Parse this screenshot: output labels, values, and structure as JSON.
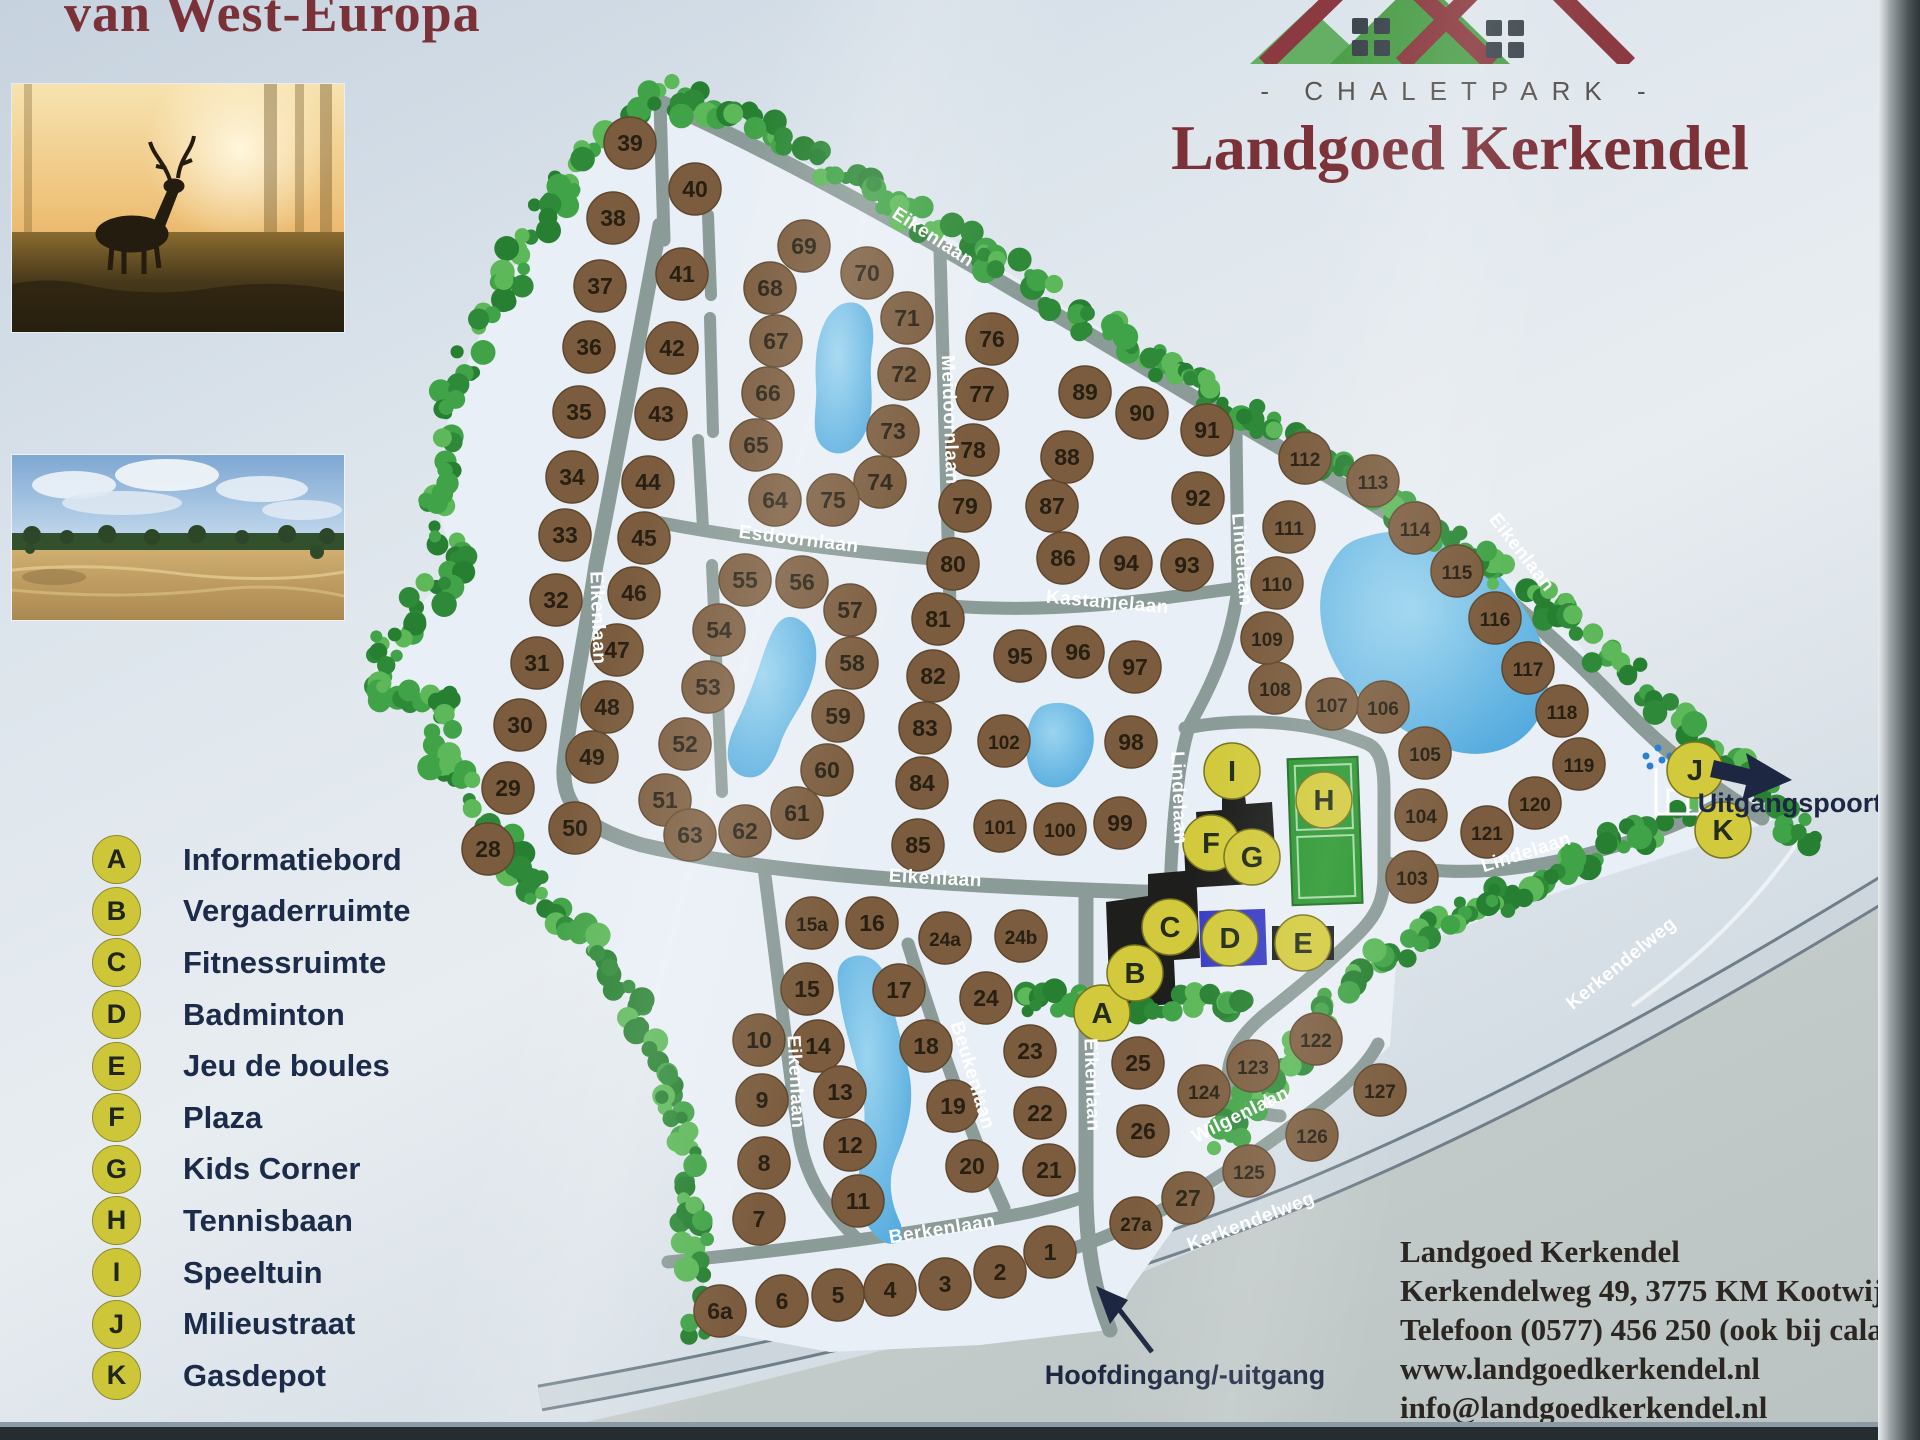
{
  "sign": {
    "top_left_title": "van West-Europa",
    "brand": {
      "park_type": "- CHALETPARK -",
      "name": "Landgoed Kerkendel"
    },
    "contact": {
      "name": "Landgoed Kerkendel",
      "address": "Kerkendelweg 49, 3775 KM Kootwijk",
      "phone": "Telefoon (0577) 456 250 (ook bij calamiteiten)",
      "website": "www.landgoedkerkendel.nl",
      "email": "info@landgoedkerkendel.nl"
    }
  },
  "legend": {
    "items": [
      {
        "key": "A",
        "label": "Informatiebord"
      },
      {
        "key": "B",
        "label": "Vergaderruimte"
      },
      {
        "key": "C",
        "label": "Fitnessruimte"
      },
      {
        "key": "D",
        "label": "Badminton"
      },
      {
        "key": "E",
        "label": "Jeu de boules"
      },
      {
        "key": "F",
        "label": "Plaza"
      },
      {
        "key": "G",
        "label": "Kids Corner"
      },
      {
        "key": "H",
        "label": "Tennisbaan"
      },
      {
        "key": "I",
        "label": "Speeltuin"
      },
      {
        "key": "J",
        "label": "Milieustraat"
      },
      {
        "key": "K",
        "label": "Gasdepot"
      }
    ]
  },
  "map": {
    "labels": {
      "entrance": {
        "text": "Hoofdingang/-uitgang",
        "x": 1185,
        "y": 1384
      },
      "exit": {
        "text": "Uitgangspoort",
        "x": 1790,
        "y": 812
      }
    },
    "icons": {
      "milieustraat": "container-station-icon",
      "entrance_arrow": "arrow-up-left-icon",
      "exit_arrow": "arrow-right-icon"
    },
    "colors": {
      "road": "#8b9b97",
      "park": "#e9eff6",
      "water": "#4fa8dd",
      "water_light": "#9bd4ef",
      "plot": "#7b5c3e",
      "plot_rim": "#5f462c",
      "plot_text": "#261f12",
      "facility": "#d2ca3c",
      "facility_rim": "#77731f",
      "facility_text": "#232d1a",
      "tree_dark": "#278031",
      "tree_mid": "#2e8a38",
      "tree_light": "#5cb858",
      "tree_soft": "#41a347",
      "building": "#1e1e1c",
      "badminton": "#3a3dc4",
      "court": "#28962e",
      "court_line": "#a8d8a8",
      "street_text": "#ffffff",
      "label_dark": "#1d2742",
      "maroon": "#7b3138"
    },
    "streets": [
      [
        "Eikenlaan",
        930,
        242,
        33
      ],
      [
        "Eikenlaan",
        592,
        618,
        88
      ],
      [
        "Eikenlaan",
        1517,
        556,
        52
      ],
      [
        "Eikenlaan",
        935,
        884,
        3
      ],
      [
        "Eikenlaan",
        790,
        1082,
        87
      ],
      [
        "Eikenlaan",
        1086,
        1085,
        88
      ],
      [
        "Esdoornlaan",
        798,
        545,
        7
      ],
      [
        "Meidoornlaan",
        944,
        420,
        88
      ],
      [
        "Kastanjelaan",
        1107,
        608,
        5
      ],
      [
        "Lindelaan",
        1236,
        560,
        85
      ],
      [
        "Lindelaan",
        1173,
        798,
        88
      ],
      [
        "Lindelaan",
        1528,
        858,
        -18
      ],
      [
        "Beukenlaan",
        967,
        1077,
        73
      ],
      [
        "Berkenlaan",
        943,
        1235,
        -9
      ],
      [
        "Wilgenlaan",
        1243,
        1120,
        -26
      ],
      [
        "Kerkendelweg",
        1253,
        1227,
        -21
      ],
      [
        "Kerkendelweg",
        1625,
        968,
        -39
      ]
    ],
    "plots": [
      [
        "39",
        630,
        143
      ],
      [
        "38",
        613,
        218
      ],
      [
        "37",
        600,
        286
      ],
      [
        "36",
        589,
        347
      ],
      [
        "35",
        579,
        412
      ],
      [
        "34",
        572,
        477
      ],
      [
        "33",
        565,
        535
      ],
      [
        "32",
        556,
        600
      ],
      [
        "31",
        537,
        663
      ],
      [
        "30",
        520,
        725
      ],
      [
        "29",
        508,
        788
      ],
      [
        "28",
        488,
        849
      ],
      [
        "40",
        695,
        189
      ],
      [
        "41",
        682,
        274
      ],
      [
        "42",
        672,
        348
      ],
      [
        "43",
        661,
        414
      ],
      [
        "44",
        648,
        482
      ],
      [
        "45",
        644,
        538
      ],
      [
        "46",
        634,
        593
      ],
      [
        "47",
        617,
        650
      ],
      [
        "48",
        607,
        707
      ],
      [
        "49",
        592,
        757
      ],
      [
        "50",
        575,
        828
      ],
      [
        "51",
        665,
        800
      ],
      [
        "52",
        685,
        744
      ],
      [
        "53",
        708,
        687
      ],
      [
        "54",
        719,
        630
      ],
      [
        "55",
        745,
        580
      ],
      [
        "56",
        802,
        582
      ],
      [
        "57",
        850,
        610
      ],
      [
        "58",
        852,
        663
      ],
      [
        "59",
        838,
        716
      ],
      [
        "60",
        827,
        770
      ],
      [
        "61",
        797,
        813
      ],
      [
        "62",
        745,
        831
      ],
      [
        "63",
        690,
        835
      ],
      [
        "64",
        775,
        500
      ],
      [
        "65",
        756,
        445
      ],
      [
        "66",
        768,
        393
      ],
      [
        "67",
        776,
        341
      ],
      [
        "68",
        770,
        288
      ],
      [
        "69",
        804,
        246
      ],
      [
        "70",
        867,
        273
      ],
      [
        "71",
        907,
        318
      ],
      [
        "72",
        904,
        374
      ],
      [
        "73",
        893,
        431
      ],
      [
        "74",
        880,
        482
      ],
      [
        "75",
        833,
        500
      ],
      [
        "76",
        992,
        339
      ],
      [
        "77",
        982,
        394
      ],
      [
        "78",
        973,
        450
      ],
      [
        "79",
        965,
        506
      ],
      [
        "80",
        953,
        564
      ],
      [
        "81",
        938,
        619
      ],
      [
        "82",
        933,
        676
      ],
      [
        "83",
        925,
        728
      ],
      [
        "84",
        922,
        783
      ],
      [
        "85",
        918,
        845
      ],
      [
        "86",
        1063,
        558
      ],
      [
        "87",
        1052,
        506
      ],
      [
        "88",
        1067,
        457
      ],
      [
        "89",
        1085,
        392
      ],
      [
        "90",
        1142,
        413
      ],
      [
        "91",
        1207,
        430
      ],
      [
        "92",
        1198,
        498
      ],
      [
        "93",
        1187,
        565
      ],
      [
        "94",
        1126,
        563
      ],
      [
        "95",
        1020,
        656
      ],
      [
        "96",
        1078,
        652
      ],
      [
        "97",
        1135,
        667
      ],
      [
        "98",
        1131,
        742
      ],
      [
        "99",
        1120,
        823
      ],
      [
        "100",
        1060,
        829
      ],
      [
        "101",
        1000,
        826
      ],
      [
        "102",
        1004,
        741
      ],
      [
        "103",
        1412,
        877
      ],
      [
        "104",
        1421,
        815
      ],
      [
        "105",
        1425,
        753
      ],
      [
        "106",
        1383,
        707
      ],
      [
        "107",
        1332,
        704
      ],
      [
        "108",
        1275,
        688
      ],
      [
        "109",
        1267,
        638
      ],
      [
        "110",
        1277,
        583
      ],
      [
        "111",
        1289,
        527
      ],
      [
        "112",
        1305,
        458
      ],
      [
        "113",
        1373,
        481
      ],
      [
        "114",
        1415,
        528
      ],
      [
        "115",
        1457,
        571
      ],
      [
        "116",
        1495,
        618
      ],
      [
        "117",
        1528,
        668
      ],
      [
        "118",
        1562,
        711
      ],
      [
        "119",
        1579,
        764
      ],
      [
        "120",
        1535,
        803
      ],
      [
        "121",
        1487,
        832
      ],
      [
        "122",
        1316,
        1039
      ],
      [
        "123",
        1253,
        1066
      ],
      [
        "124",
        1204,
        1091
      ],
      [
        "125",
        1249,
        1171
      ],
      [
        "126",
        1312,
        1135
      ],
      [
        "127",
        1380,
        1090
      ],
      [
        "15a",
        812,
        923
      ],
      [
        "16",
        872,
        923
      ],
      [
        "24a",
        945,
        938
      ],
      [
        "24b",
        1021,
        936
      ],
      [
        "15",
        807,
        989
      ],
      [
        "17",
        899,
        990
      ],
      [
        "24",
        986,
        998
      ],
      [
        "10",
        759,
        1040
      ],
      [
        "14",
        818,
        1046
      ],
      [
        "18",
        926,
        1046
      ],
      [
        "23",
        1030,
        1051
      ],
      [
        "25",
        1138,
        1063
      ],
      [
        "9",
        762,
        1100
      ],
      [
        "13",
        840,
        1092
      ],
      [
        "19",
        953,
        1106
      ],
      [
        "22",
        1040,
        1113
      ],
      [
        "26",
        1143,
        1131
      ],
      [
        "8",
        764,
        1163
      ],
      [
        "12",
        850,
        1145
      ],
      [
        "20",
        972,
        1166
      ],
      [
        "21",
        1049,
        1170
      ],
      [
        "27",
        1188,
        1198
      ],
      [
        "7",
        759,
        1219
      ],
      [
        "11",
        858,
        1201
      ],
      [
        "27a",
        1136,
        1223
      ],
      [
        "1",
        1050,
        1252
      ],
      [
        "2",
        1000,
        1272
      ],
      [
        "3",
        945,
        1284
      ],
      [
        "4",
        890,
        1290
      ],
      [
        "5",
        838,
        1295
      ],
      [
        "6",
        782,
        1301
      ],
      [
        "6a",
        720,
        1311
      ]
    ],
    "facilities": [
      [
        "A",
        1102,
        1013
      ],
      [
        "B",
        1135,
        973
      ],
      [
        "C",
        1170,
        927
      ],
      [
        "D",
        1230,
        938
      ],
      [
        "E",
        1303,
        943
      ],
      [
        "F",
        1211,
        843
      ],
      [
        "G",
        1252,
        857
      ],
      [
        "H",
        1324,
        800
      ],
      [
        "I",
        1232,
        771
      ],
      [
        "J",
        1695,
        770
      ],
      [
        "K",
        1723,
        830
      ]
    ]
  }
}
